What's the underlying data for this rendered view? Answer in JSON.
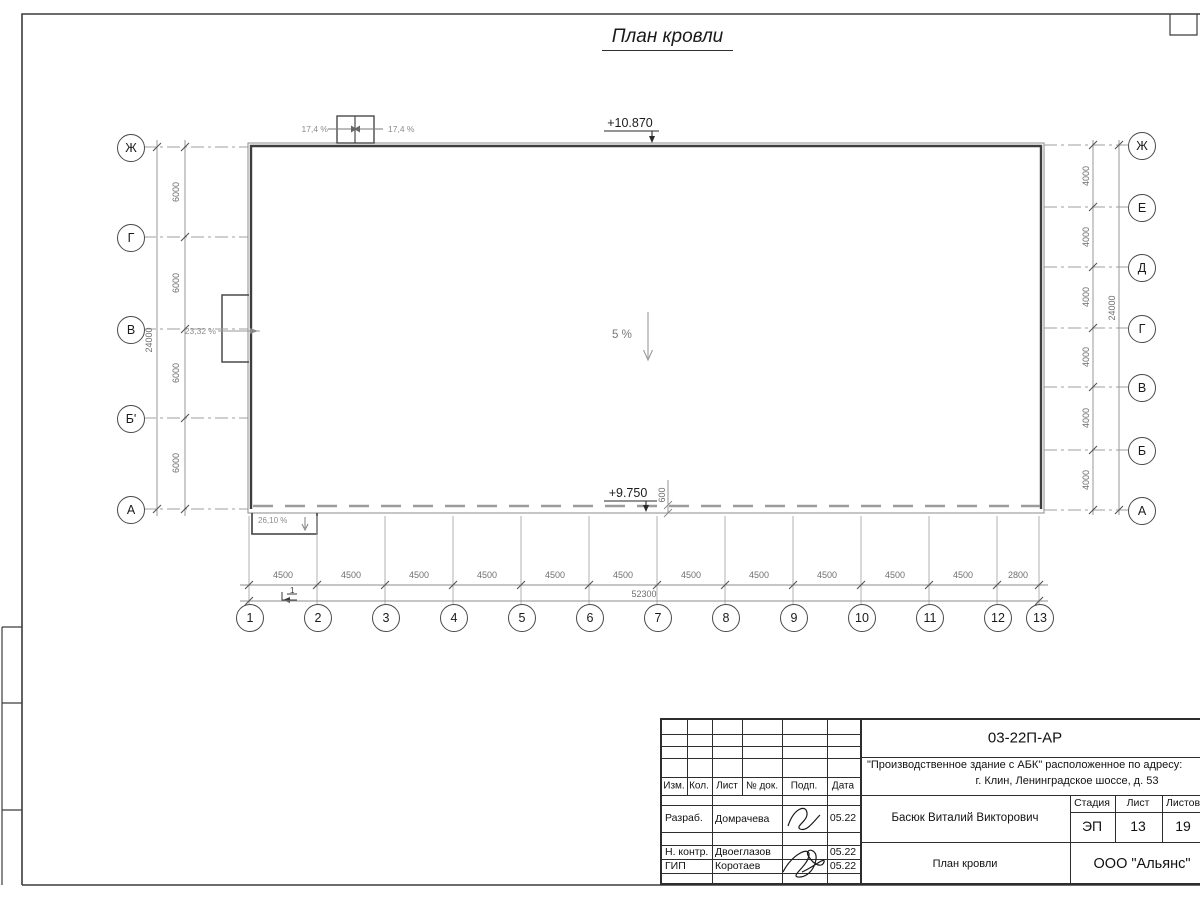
{
  "title": "План кровли",
  "drawing": {
    "elevation_top": "+10.870",
    "elevation_bottom": "+9.750",
    "slope_shaft_left": "17,4 %",
    "slope_shaft_right": "17,4 %",
    "slope_left": "23,32 %",
    "slope_canopy": "26,10 %",
    "slope_main": "5 %",
    "parapet_dim": "600",
    "section_mark": "1",
    "axes_left": [
      "Ж",
      "Г",
      "В",
      "Б'",
      "А"
    ],
    "axes_right": [
      "Ж",
      "Е",
      "Д",
      "Г",
      "В",
      "Б",
      "А"
    ],
    "columns": [
      "1",
      "2",
      "3",
      "4",
      "5",
      "6",
      "7",
      "8",
      "9",
      "10",
      "11",
      "12",
      "13"
    ],
    "dims_left": [
      "6000",
      "6000",
      "6000",
      "6000"
    ],
    "dims_left_total": "24000",
    "dims_right": [
      "4000",
      "4000",
      "4000",
      "4000",
      "4000",
      "4000"
    ],
    "dims_right_total": "24000",
    "dims_bottom": [
      "4500",
      "4500",
      "4500",
      "4500",
      "4500",
      "4500",
      "4500",
      "4500",
      "4500",
      "4500",
      "4500",
      "2800"
    ],
    "dims_bottom_total": "52300"
  },
  "title_block": {
    "doc_number": "03-22П-АР",
    "project_line1": "\"Производственное здание с АБК\" расположенное по адресу:",
    "project_line2": "г. Клин, Ленинградское шоссе, д. 53",
    "col_headers": {
      "izm": "Изм.",
      "kol": "Кол.",
      "list": "Лист",
      "doc": "№ док.",
      "podp": "Подп.",
      "date": "Дата"
    },
    "stage_headers": {
      "stage": "Стадия",
      "sheet": "Лист",
      "sheets": "Листов"
    },
    "rows": [
      {
        "role": "Разраб.",
        "name": "Домрачева",
        "date": "05.22"
      },
      {
        "role": "Н. контр.",
        "name": "Двоеглазов",
        "date": "05.22"
      },
      {
        "role": "ГИП",
        "name": "Коротаев",
        "date": "05.22"
      }
    ],
    "approver": "Басюк Виталий Викторович",
    "stage": "ЭП",
    "sheet": "13",
    "sheets": "19",
    "drawing_name": "План кровли",
    "company": "ООО \"Альянс\""
  }
}
